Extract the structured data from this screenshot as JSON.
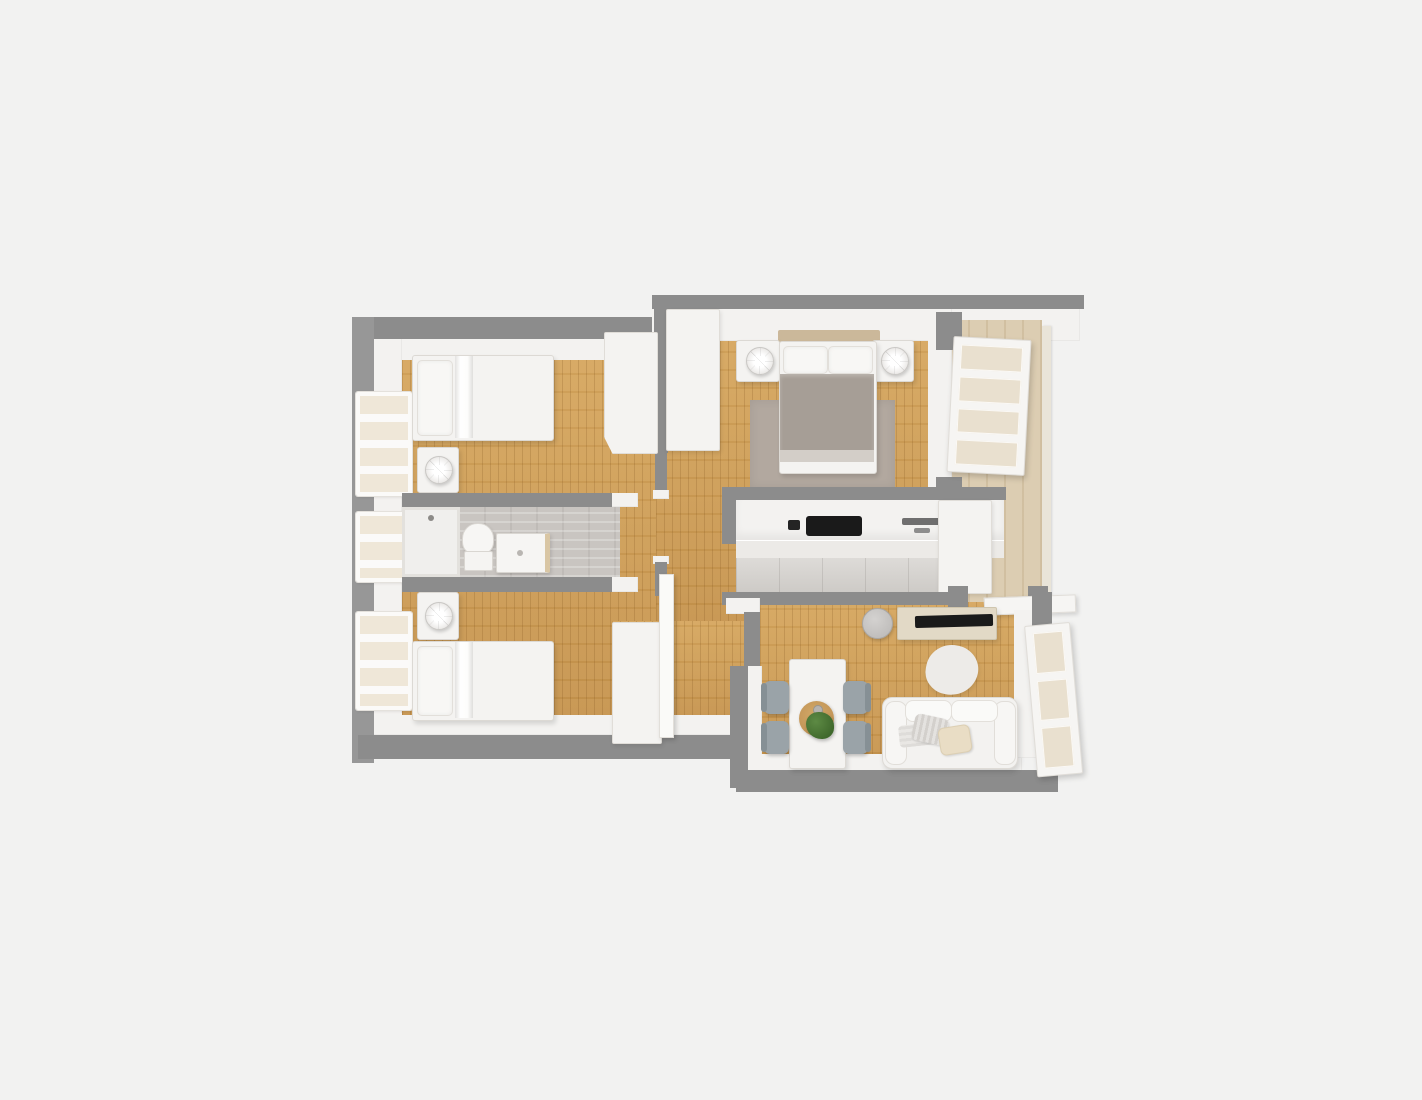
{
  "scene": {
    "title": "3D apartment floor plan render (top-down)",
    "view": "top-down isometric render",
    "colors": {
      "background": "#f2f2f1",
      "wall_outer": "#8c8c8c",
      "wall_inner": "#f3f2f0",
      "floor_wood": "#cd9c55",
      "floor_tile_bath": "#c9c5c1",
      "floor_tile_kitchen": "#d6d3cf",
      "floor_balcony": "#dccdb2",
      "furniture_white": "#f4f3f1",
      "blanket_gray": "#a69e96",
      "bedroom_rug": "#b2a89f",
      "headboard_wood": "#cbb89a",
      "chair_gray": "#9aa3a8",
      "plant_green": "#4c7a36",
      "tv_black": "#1a1a1a",
      "console_beige": "#e2d9c6",
      "placemat_wood": "#c39557"
    },
    "rooms": [
      {
        "name": "bedroom-top-left",
        "furniture": [
          "single bed with pillow and draped sheet",
          "nightstand with round lamp",
          "wardrobe",
          "two-pane window wall"
        ]
      },
      {
        "name": "bathroom-middle-left",
        "furniture": [
          "walk-in shower",
          "toilet",
          "sink vanity",
          "window",
          "gray tile floor"
        ]
      },
      {
        "name": "bedroom-bottom-left",
        "furniture": [
          "single bed with pillow and draped sheet",
          "nightstand with round lamp",
          "wardrobe",
          "window",
          "open white door"
        ]
      },
      {
        "name": "hallway-center",
        "furniture": [
          "entry closet",
          "wood flooring"
        ]
      },
      {
        "name": "master-bedroom-top-right",
        "furniture": [
          "double bed with gray blanket",
          "wood headboard",
          "two nightstands",
          "two round table lamps",
          "gray area rug"
        ]
      },
      {
        "name": "kitchen-center-right",
        "furniture": [
          "white cabinet run",
          "black cooktop",
          "sink",
          "fridge column",
          "tiled floor",
          "wall ledge"
        ]
      },
      {
        "name": "balcony-right",
        "furniture": [
          "beige tile floor",
          "open glass door with four panes"
        ]
      },
      {
        "name": "living-dining-bottom-right",
        "furniture": [
          "dining table",
          "four gray chairs",
          "round wood placemat",
          "potted plant",
          "white two-seat sofa",
          "three cushions",
          "TV console",
          "flat TV",
          "round side table",
          "organic-shape rug",
          "open glass door with three panes"
        ]
      }
    ]
  }
}
